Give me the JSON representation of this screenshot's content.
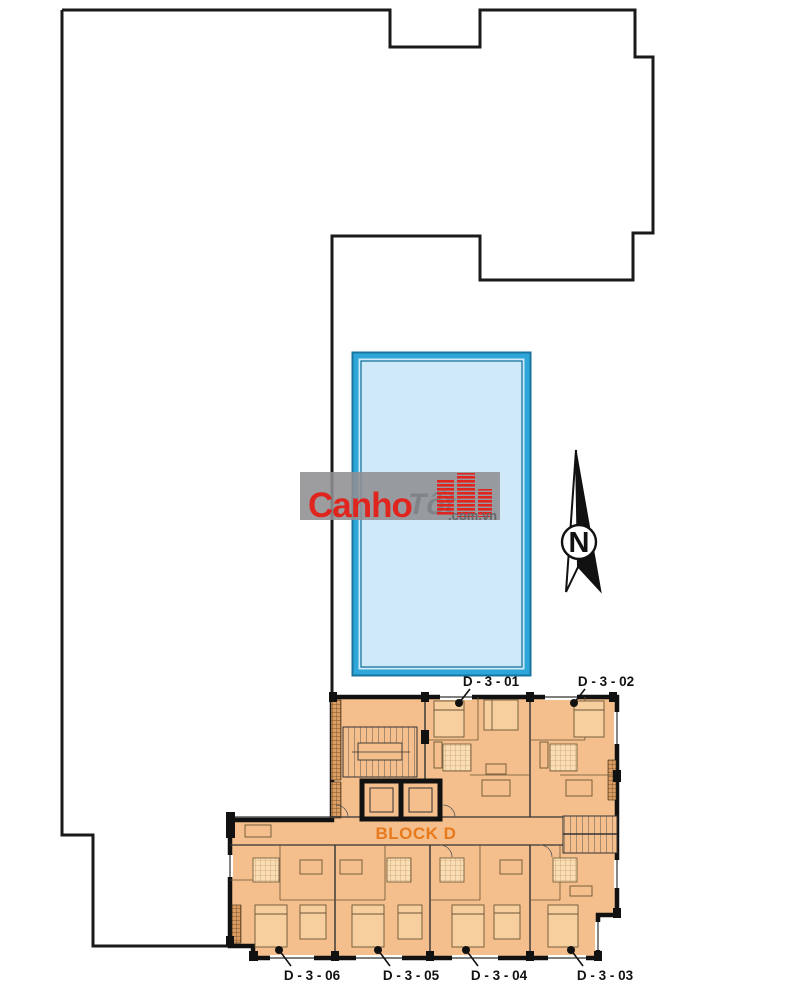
{
  "plan": {
    "block_label": "BLOCK D",
    "units_top": [
      {
        "label": "D - 3 - 01"
      },
      {
        "label": "D - 3 - 02"
      }
    ],
    "units_bottom": [
      {
        "label": "D - 3 - 06"
      },
      {
        "label": "D - 3 - 05"
      },
      {
        "label": "D - 3 - 04"
      },
      {
        "label": "D - 3 - 03"
      }
    ]
  },
  "compass": {
    "label": "N"
  },
  "watermark": {
    "brand": "Canho",
    "suffix": ".com.vn",
    "ghost": "Tốt"
  },
  "colors": {
    "plan_fill": "#f4bf8c",
    "wall": "#111111",
    "site_outline": "#1a1a1a",
    "block_label": "#e87a1e",
    "unit_label": "#111111",
    "pool_water": "#cfe9f8",
    "pool_border": "#2ea6da",
    "pool_border_dark": "#17759f",
    "watermark_red": "#e0251f",
    "watermark_band": "#8f8f93"
  }
}
